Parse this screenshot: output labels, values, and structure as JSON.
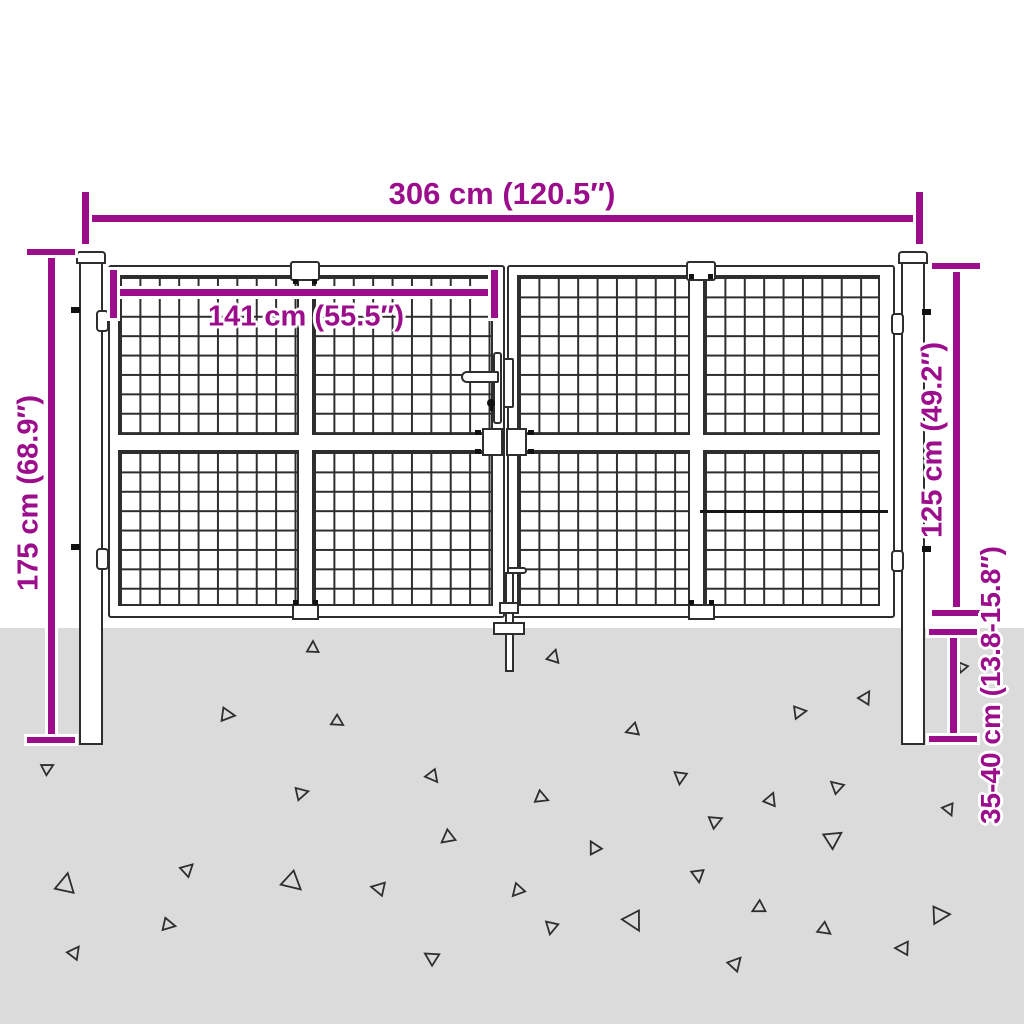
{
  "meta": {
    "title": "Mesh garden double gate with posts - dimension diagram"
  },
  "colors": {
    "accent": "#9C0D8C",
    "ground": "#DBDBDB",
    "line": "#2E2E2E"
  },
  "dimensions": {
    "total_width": {
      "label": "306 cm (120.5″)",
      "orientation": "horizontal"
    },
    "leaf_width": {
      "label": "141 cm (55.5″)",
      "orientation": "horizontal"
    },
    "post_height": {
      "label": "175 cm (68.9″)",
      "orientation": "vertical"
    },
    "gate_height": {
      "label": "125 cm (49.2″)",
      "orientation": "vertical"
    },
    "below_ground": {
      "label": "35-40 cm (13.8-15.8″)",
      "orientation": "vertical"
    }
  },
  "ground": {
    "triangles": [
      {
        "x": 313,
        "y": 647,
        "s": 12,
        "r": 0
      },
      {
        "x": 554,
        "y": 656,
        "s": 13,
        "r": 15
      },
      {
        "x": 962,
        "y": 668,
        "s": 10,
        "r": 200
      },
      {
        "x": 866,
        "y": 697,
        "s": 13,
        "r": 30
      },
      {
        "x": 228,
        "y": 715,
        "s": 14,
        "r": 95
      },
      {
        "x": 338,
        "y": 722,
        "s": 12,
        "r": 120
      },
      {
        "x": 632,
        "y": 730,
        "s": 13,
        "r": 250
      },
      {
        "x": 800,
        "y": 712,
        "s": 13,
        "r": 80
      },
      {
        "x": 48,
        "y": 768,
        "s": 12,
        "r": 60
      },
      {
        "x": 433,
        "y": 777,
        "s": 13,
        "r": 140
      },
      {
        "x": 302,
        "y": 793,
        "s": 13,
        "r": 75
      },
      {
        "x": 680,
        "y": 778,
        "s": 13,
        "r": 185
      },
      {
        "x": 542,
        "y": 798,
        "s": 13,
        "r": 110
      },
      {
        "x": 771,
        "y": 799,
        "s": 13,
        "r": 20
      },
      {
        "x": 836,
        "y": 786,
        "s": 13,
        "r": 310
      },
      {
        "x": 716,
        "y": 821,
        "s": 13,
        "r": 65
      },
      {
        "x": 949,
        "y": 810,
        "s": 12,
        "r": 155
      },
      {
        "x": 447,
        "y": 838,
        "s": 14,
        "r": 230
      },
      {
        "x": 188,
        "y": 869,
        "s": 13,
        "r": 45
      },
      {
        "x": 66,
        "y": 883,
        "s": 20,
        "r": 10
      },
      {
        "x": 293,
        "y": 883,
        "s": 20,
        "r": 130
      },
      {
        "x": 378,
        "y": 888,
        "s": 14,
        "r": 280
      },
      {
        "x": 594,
        "y": 847,
        "s": 13,
        "r": 330
      },
      {
        "x": 834,
        "y": 838,
        "s": 18,
        "r": 55
      },
      {
        "x": 698,
        "y": 876,
        "s": 13,
        "r": 170
      },
      {
        "x": 517,
        "y": 891,
        "s": 13,
        "r": 220
      },
      {
        "x": 169,
        "y": 925,
        "s": 13,
        "r": 100
      },
      {
        "x": 75,
        "y": 952,
        "s": 13,
        "r": 35
      },
      {
        "x": 431,
        "y": 957,
        "s": 14,
        "r": 300
      },
      {
        "x": 634,
        "y": 922,
        "s": 20,
        "r": 150
      },
      {
        "x": 758,
        "y": 908,
        "s": 13,
        "r": 240
      },
      {
        "x": 941,
        "y": 915,
        "s": 18,
        "r": 85
      },
      {
        "x": 551,
        "y": 928,
        "s": 13,
        "r": 190
      },
      {
        "x": 825,
        "y": 930,
        "s": 13,
        "r": 125
      },
      {
        "x": 902,
        "y": 948,
        "s": 14,
        "r": 270
      },
      {
        "x": 736,
        "y": 963,
        "s": 14,
        "r": 40
      }
    ]
  }
}
